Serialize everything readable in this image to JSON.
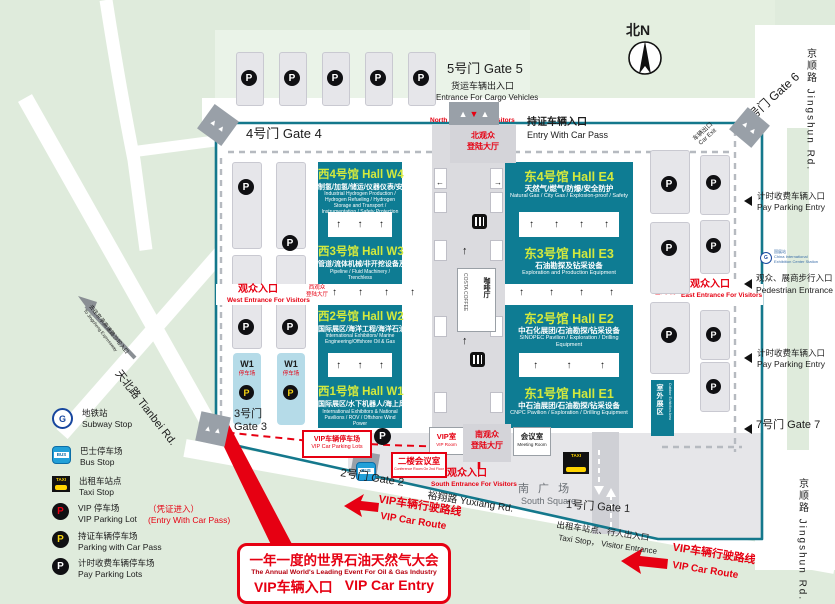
{
  "colors": {
    "teal_hall": "#0e7c93",
    "fence": "#14788c",
    "green": "#dfebdc",
    "red": "#e60012",
    "hall_title_yellow": "#d3e93d"
  },
  "top": {
    "gate4_label": "4号门 Gate 4",
    "gate5_label": "5号门 Gate 5",
    "cargo_cn": "货运车辆出入口",
    "cargo_en": "Entrance For Cargo Vehicles",
    "visitor_cn": "观众入口",
    "visitor_en": "North Entrance For Visitors",
    "lobby_l1": "北观众",
    "lobby_l2": "登陆大厅",
    "carpass_cn": "持证车辆入口",
    "carpass_en": "Entry With Car Pass",
    "gate6_label": "6号门 Gate 6",
    "car_exit_cn": "车辆出口",
    "car_exit_en": "Car Exit",
    "compass": "北N"
  },
  "roads": {
    "jingshun_top": "京顺路 Jingshun Rd.",
    "jingshun_bottom": "京顺路 Jingshun Rd.",
    "tianbei": "天北路 Tianbei Rd.",
    "yuxiang": "裕翔路 Yuxiang Rd.",
    "expressway_cn": "去往京承高速路沙坨入口",
    "expressway_en": "To Jingcheng Expressway"
  },
  "halls": [
    {
      "id": "w4",
      "title": "西4号馆  Hall W4",
      "cn": "制氢/加氢/储运/仪器仪表/安全防护",
      "en": "Industrial Hydrogen Production / Hydrogen Refueling / Hydrogen Storage and Transport / Instrumentation / Safety Protection"
    },
    {
      "id": "w3",
      "title": "西3号馆  Hall W3",
      "cn": "管道/流体机械/非开挖设备及技术",
      "en": "Pipeline / Fluid Machinery / Trenchless"
    },
    {
      "id": "w2",
      "title": "西2号馆  Hall W2",
      "cn": "国际展区/海洋工程/海洋石油",
      "en": "International Exhibitors/ Marine Engineering/Offshore Oil & Gas"
    },
    {
      "id": "w1",
      "title": "西1号馆  Hall W1",
      "cn": "国际展区/水下机器人/海上风电",
      "en": "International Exhibitors & National Pavilions / ROV / Offshore Wind Power"
    },
    {
      "id": "e4",
      "title": "东4号馆 Hall E4",
      "cn": "天然气/燃气/防爆/安全防护",
      "en": "Natural Gas / City Gas / Explosion-proof / Safety"
    },
    {
      "id": "e3",
      "title": "东3号馆 Hall E3",
      "cn": "石油勘探及钻采设备",
      "en": "Exploration and Production Equipment"
    },
    {
      "id": "e2",
      "title": "东2号馆 Hall E2",
      "cn": "中石化展团/石油勘探/钻采设备",
      "en": "SINOPEC Pavilion / Exploration / Drilling Equipment"
    },
    {
      "id": "e1",
      "title": "东1号馆 Hall E1",
      "cn": "中石油展团/石油勘探/钻采设备",
      "en": "CNPC Pavilion / Exploration / Drilling Equipment"
    }
  ],
  "west_entrance": {
    "cn": "观众入口",
    "en": "West Entrance For Visitors",
    "lobby_l1": "西观众",
    "lobby_l2": "登陆大厅"
  },
  "east_entrance": {
    "cn": "观众入口",
    "en": "East Entrance For Visitors",
    "lobby_l1": "东观众",
    "lobby_l2": "登陆大厅"
  },
  "south_entrance": {
    "cn": "观众入口",
    "en": "South Entrance For Visitors",
    "lobby_l1": "南观众",
    "lobby_l2": "登陆大厅"
  },
  "center": {
    "coffee_cn": "咖啡厅",
    "coffee_en": "COSTA COFFEE",
    "vip_room_cn": "VIP室",
    "vip_room_en": "VIP Room",
    "meeting_cn": "会议室",
    "meeting_en": "Meeting Room",
    "outdoor_cn": "室外展区",
    "outdoor_en": "Outdoor Exhibition Area",
    "w1_label": "W1",
    "w1_sub": "停车场"
  },
  "east_side": {
    "pay_entry_cn": "计时收费车辆入口",
    "pay_entry_en": "Pay Parking Entry",
    "metro_cn": "国展站",
    "metro_en": "China International Exhibition Center Station",
    "pedestrian_cn": "观众、展商步行入口",
    "pedestrian_en": "Pedestrian Entrance",
    "pay_entry2_cn": "计时收费车辆入口",
    "pay_entry2_en": "Pay Parking Entry",
    "gate7_label": "7号门 Gate 7"
  },
  "south_area": {
    "gate1_label": "1号门 Gate 1",
    "gate2_label": "2号门 Gate 2",
    "gate3_l1": "3号门",
    "gate3_l2": "Gate 3",
    "square_cn": "南 广 场",
    "square_en": "South Square",
    "taxi_cn": "出租车站点、行人出入口",
    "taxi_en": "Taxi Stop， Visitor Entrance"
  },
  "vip": {
    "parking_cn": "VIP车辆停车场",
    "parking_en": "VIP Car Parking Lots",
    "conf_cn": "二楼会议室",
    "conf_en": "Conference Room On 2nd Floor",
    "route_cn": "VIP车辆行驶路线",
    "route_en": "VIP Car Route",
    "route2_cn": "VIP车辆行驶路线",
    "route2_en": "VIP Car Route",
    "callout_cn": "一年一度的世界石油天然气大会",
    "callout_en": "The Annual World's Leading Event For Oil & Gas Industry",
    "entry_cn": "VIP车辆入口",
    "entry_en": "VIP Car Entry"
  },
  "legend": {
    "items": [
      {
        "cn": "地铁站",
        "en": "Subway Stop"
      },
      {
        "cn": "巴士停车场",
        "en": "Bus Stop"
      },
      {
        "cn": "出租车站点",
        "en": "Taxi Stop"
      },
      {
        "cn": "VIP 停车场",
        "en": "VIP Parking Lot",
        "note_cn": "（凭证进入）",
        "note_en": "(Entry With Car Pass)"
      },
      {
        "cn": "持证车辆停车场",
        "en": "Parking with Car Pass"
      },
      {
        "cn": "计时收费车辆停车场",
        "en": "Pay Parking Lots"
      }
    ]
  },
  "icons": {
    "p_letter": "P",
    "bus_text": "BUS",
    "taxi_text": "TAXI",
    "metro_letter": "G"
  }
}
